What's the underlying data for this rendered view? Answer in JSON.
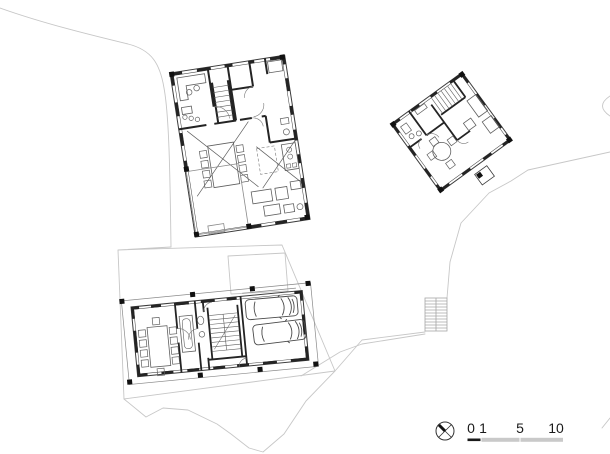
{
  "drawing": {
    "type": "architectural-site-plan",
    "background": "#ffffff"
  },
  "colors": {
    "wall": "#242424",
    "outline": "#3c3c3c",
    "furniture": "#5f5f5f",
    "thin": "#8a8a8a",
    "faint": "#c7c7c7",
    "stair_gray": "#a6a6a6",
    "scale_dark": "#1a1a1a",
    "scale_light": "#c9c9c9"
  },
  "scale_bar": {
    "labels": [
      "0",
      "1",
      "5",
      "10"
    ]
  },
  "icons": {
    "north_symbol": "north-arrow-circle-cross"
  }
}
